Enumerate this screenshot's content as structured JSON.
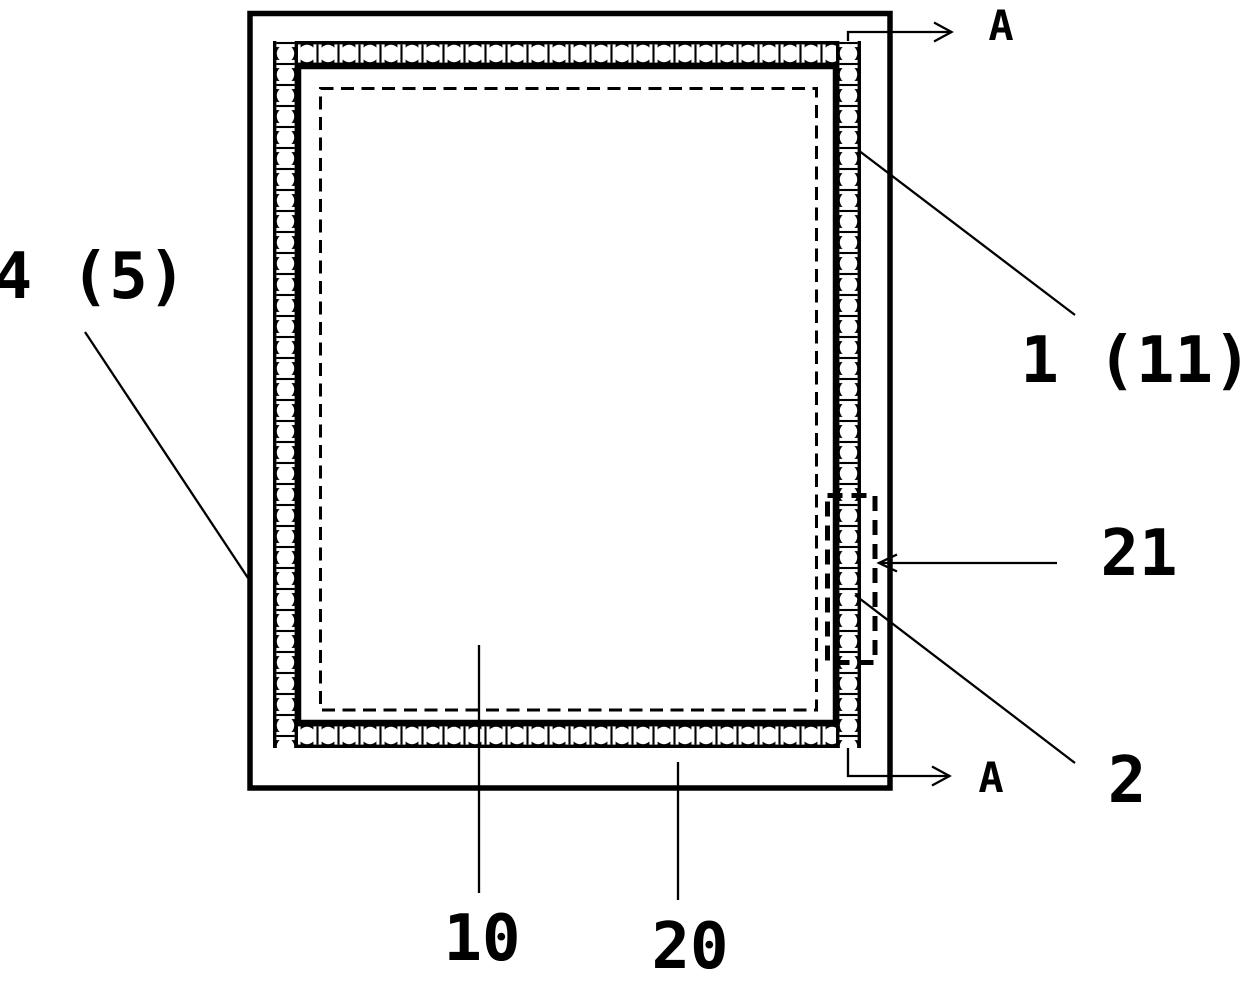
{
  "figure": {
    "background_color": "#ffffff",
    "ink_color": "#000000",
    "callouts": [
      {
        "id": "label-4-5",
        "text": "4 (5)"
      },
      {
        "id": "label-1-11",
        "text": "1 (11)"
      },
      {
        "id": "label-21",
        "text": "21"
      },
      {
        "id": "label-2",
        "text": "2"
      },
      {
        "id": "label-10",
        "text": "10"
      },
      {
        "id": "label-20",
        "text": "20"
      }
    ],
    "section_markers": [
      {
        "id": "section-a-top",
        "text": "A"
      },
      {
        "id": "section-a-bottom",
        "text": "A"
      }
    ]
  }
}
